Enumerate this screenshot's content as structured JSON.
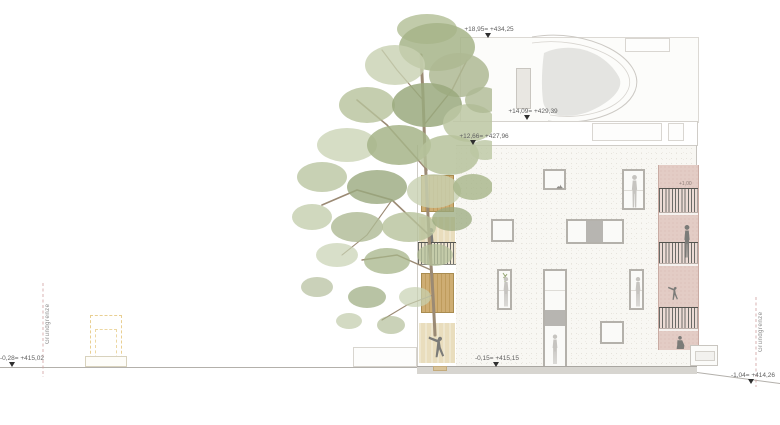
{
  "drawing": {
    "kind": "architectural elevation (Ansicht)",
    "labels": {
      "level_top": "+18,95= +434,25",
      "level_attic": "+14,09= +429,39",
      "level_roof_terrace": "+12,66= +427,96",
      "level_ground_building": "-0,15= +415,15",
      "level_ground_left": "-0,28= +415,02",
      "level_ground_right": "-1,04= +414,26",
      "boundary_left": "Grundgrenze",
      "boundary_right": "Grundgrenze",
      "balcony_mini_level": "+1,00"
    },
    "colors": {
      "facade_white": "#f8f7f3",
      "wood_slats": "#c9a96b",
      "loggia_back": "#e9ddbd",
      "loggia_pink": "#e3ccc5",
      "foliage_green": "#aeb993",
      "branch_brown": "#9b8a74",
      "ground_line": "#b3b0ab",
      "boundary_dash": "#cfa0a0",
      "demolition_dash": "#e9cf92",
      "label_text": "#5f5f5f"
    }
  }
}
